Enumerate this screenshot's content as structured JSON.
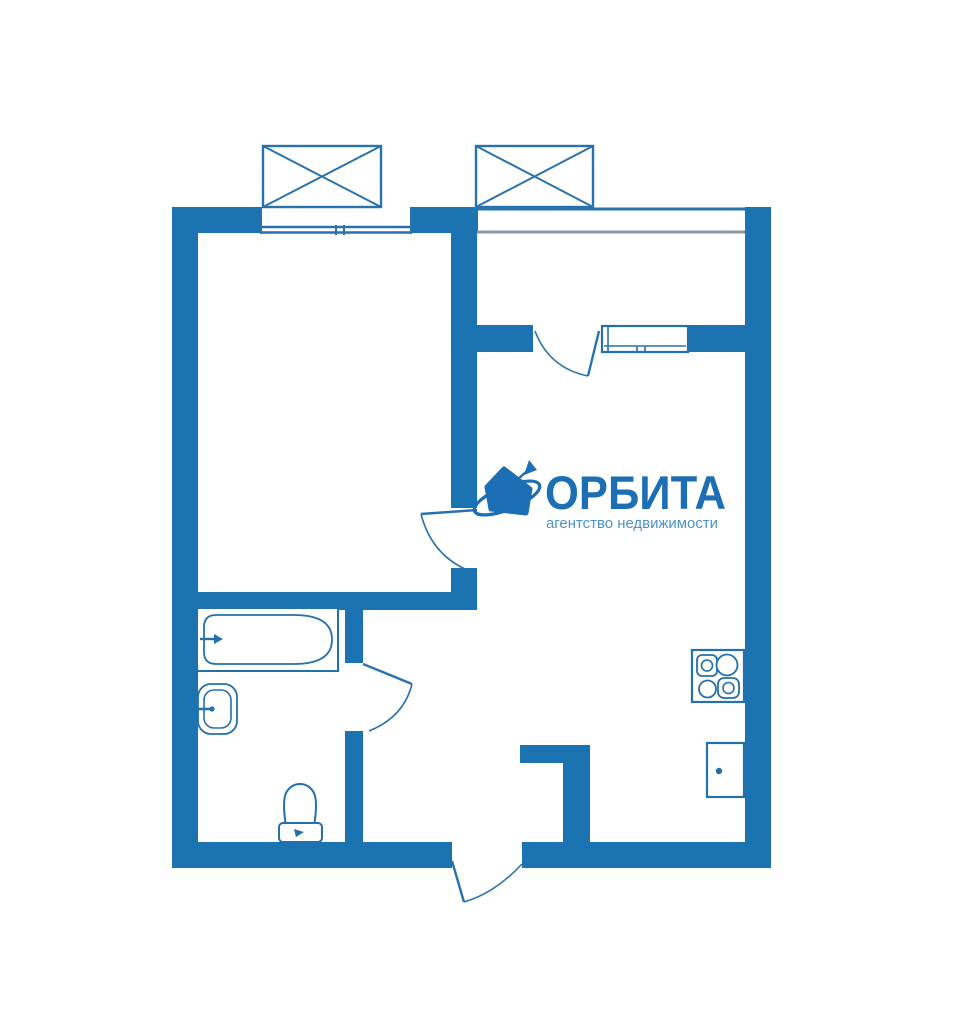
{
  "logo": {
    "title": "ОРБИТА",
    "subtitle": "агентство недвижимости",
    "icon": "house-orbit-icon"
  },
  "colors": {
    "wall": "#1b73b1",
    "thin_line": "#2a72ad",
    "gray_line": "#8e959e",
    "fixture": "#2470ab",
    "logo_title": "#1d6fb5",
    "logo_subtitle": "#4b93c9"
  },
  "plan": {
    "type": "apartment-floor-plan",
    "openings": [
      "bedroom-window",
      "loggia-window",
      "bedroom-door",
      "bathroom-door",
      "loggia-door",
      "entrance-door"
    ],
    "balconies": [
      "balcony-left",
      "balcony-right"
    ],
    "fixtures": [
      "bathtub",
      "washbasin",
      "toilet",
      "stove",
      "kitchen-sink"
    ]
  }
}
